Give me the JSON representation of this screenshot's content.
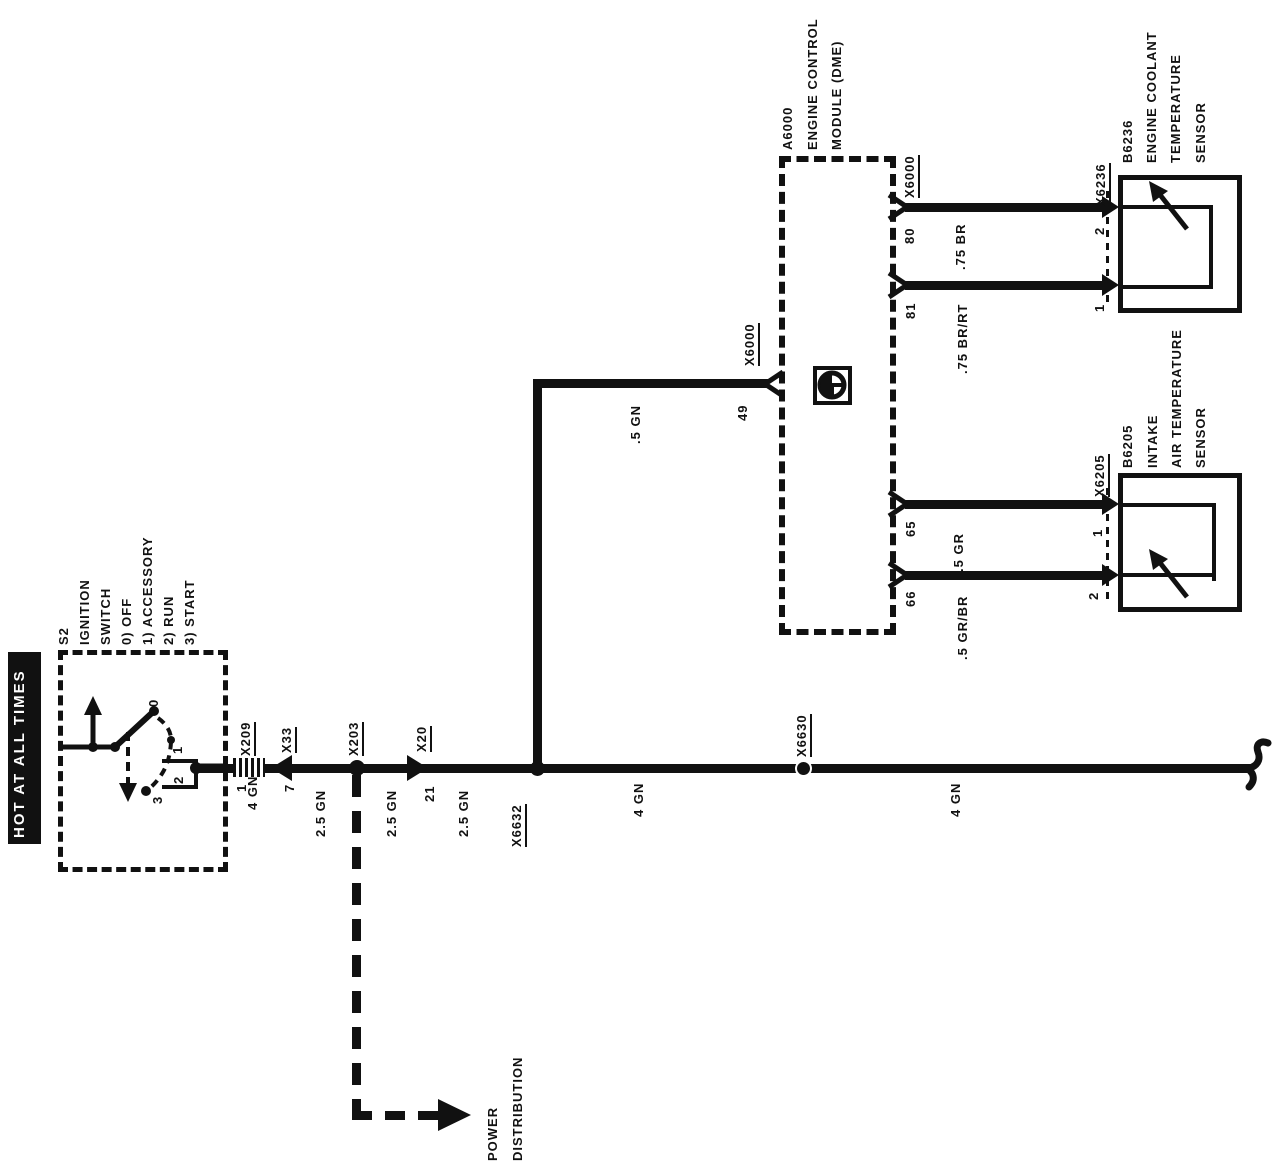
{
  "colors": {
    "ink": "#111111",
    "paper": "#ffffff"
  },
  "banner": {
    "text": "HOT AT ALL TIMES"
  },
  "ignition": {
    "id": "S2",
    "name1": "IGNITION",
    "name2": "SWITCH",
    "pos0": "0) OFF",
    "pos1": "1) ACCESSORY",
    "pos2": "2) RUN",
    "pos3": "3) START",
    "c0": "0",
    "c1": "1",
    "c2": "2",
    "c3": "3"
  },
  "bus": {
    "x209": "X209",
    "x209_pin": "1",
    "x209_wire": "4 GN",
    "x33": "X33",
    "x33_pin": "7",
    "x33_wire": "2.5 GN",
    "x203": "X203",
    "x203_wire": "2.5 GN",
    "x20": "X20",
    "x20_pin": "21",
    "x20_wire": "2.5 GN",
    "x6632": "X6632",
    "x6632_wire": "4 GN",
    "x6630": "X6630",
    "x6630_wire": "4 GN"
  },
  "dme": {
    "id": "A6000",
    "name1": "ENGINE CONTROL",
    "name2": "MODULE (DME)",
    "conn49": "X6000",
    "pin49": "49",
    "wire49": ".5 GN",
    "conn_right": "X6000",
    "pin80": "80",
    "pin81": "81",
    "pin65": "65",
    "pin66": "66"
  },
  "coolant": {
    "wire80": ".75 BR",
    "wire81": ".75 BR/RT",
    "conn": "X6236",
    "pin2": "2",
    "pin1": "1",
    "id": "B6236",
    "name1": "ENGINE COOLANT",
    "name2": "TEMPERATURE",
    "name3": "SENSOR"
  },
  "intake": {
    "wire65": ".5 GR",
    "wire66": ".5 GR/BR",
    "conn": "X6205",
    "pin1": "1",
    "pin2": "2",
    "id": "B6205",
    "name1": "INTAKE",
    "name2": "AIR TEMPERATURE",
    "name3": "SENSOR"
  },
  "power": {
    "line1": "POWER",
    "line2": "DISTRIBUTION"
  }
}
